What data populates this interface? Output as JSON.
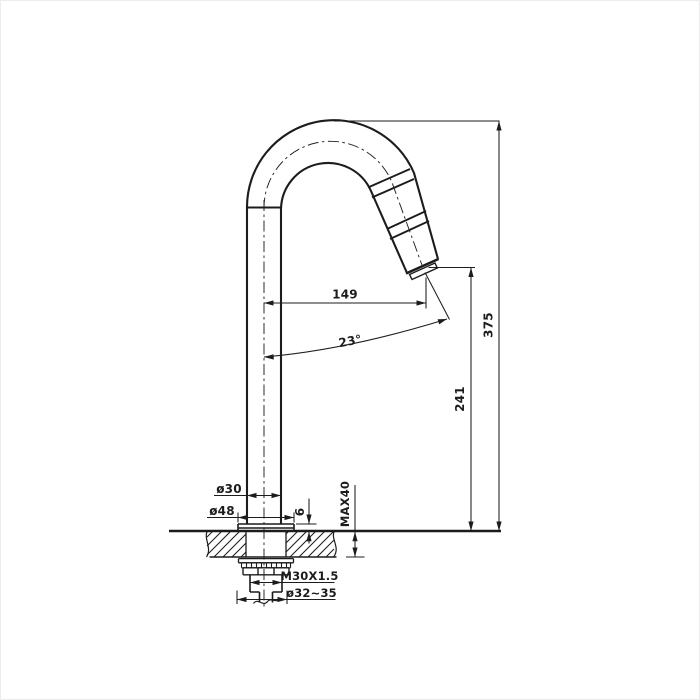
{
  "colors": {
    "line": "#1c1c1c",
    "background": "#ffffff"
  },
  "dimensions": {
    "spout_reach": "149",
    "spout_angle": "23°",
    "overall_height": "375",
    "outlet_height": "241",
    "pipe_diameter": "ø30",
    "base_diameter": "ø48",
    "base_plate_thickness": "6",
    "max_deck_thickness": "MAX40",
    "thread_spec": "M30X1.5",
    "mount_hole_diameter": "ø32~35"
  }
}
